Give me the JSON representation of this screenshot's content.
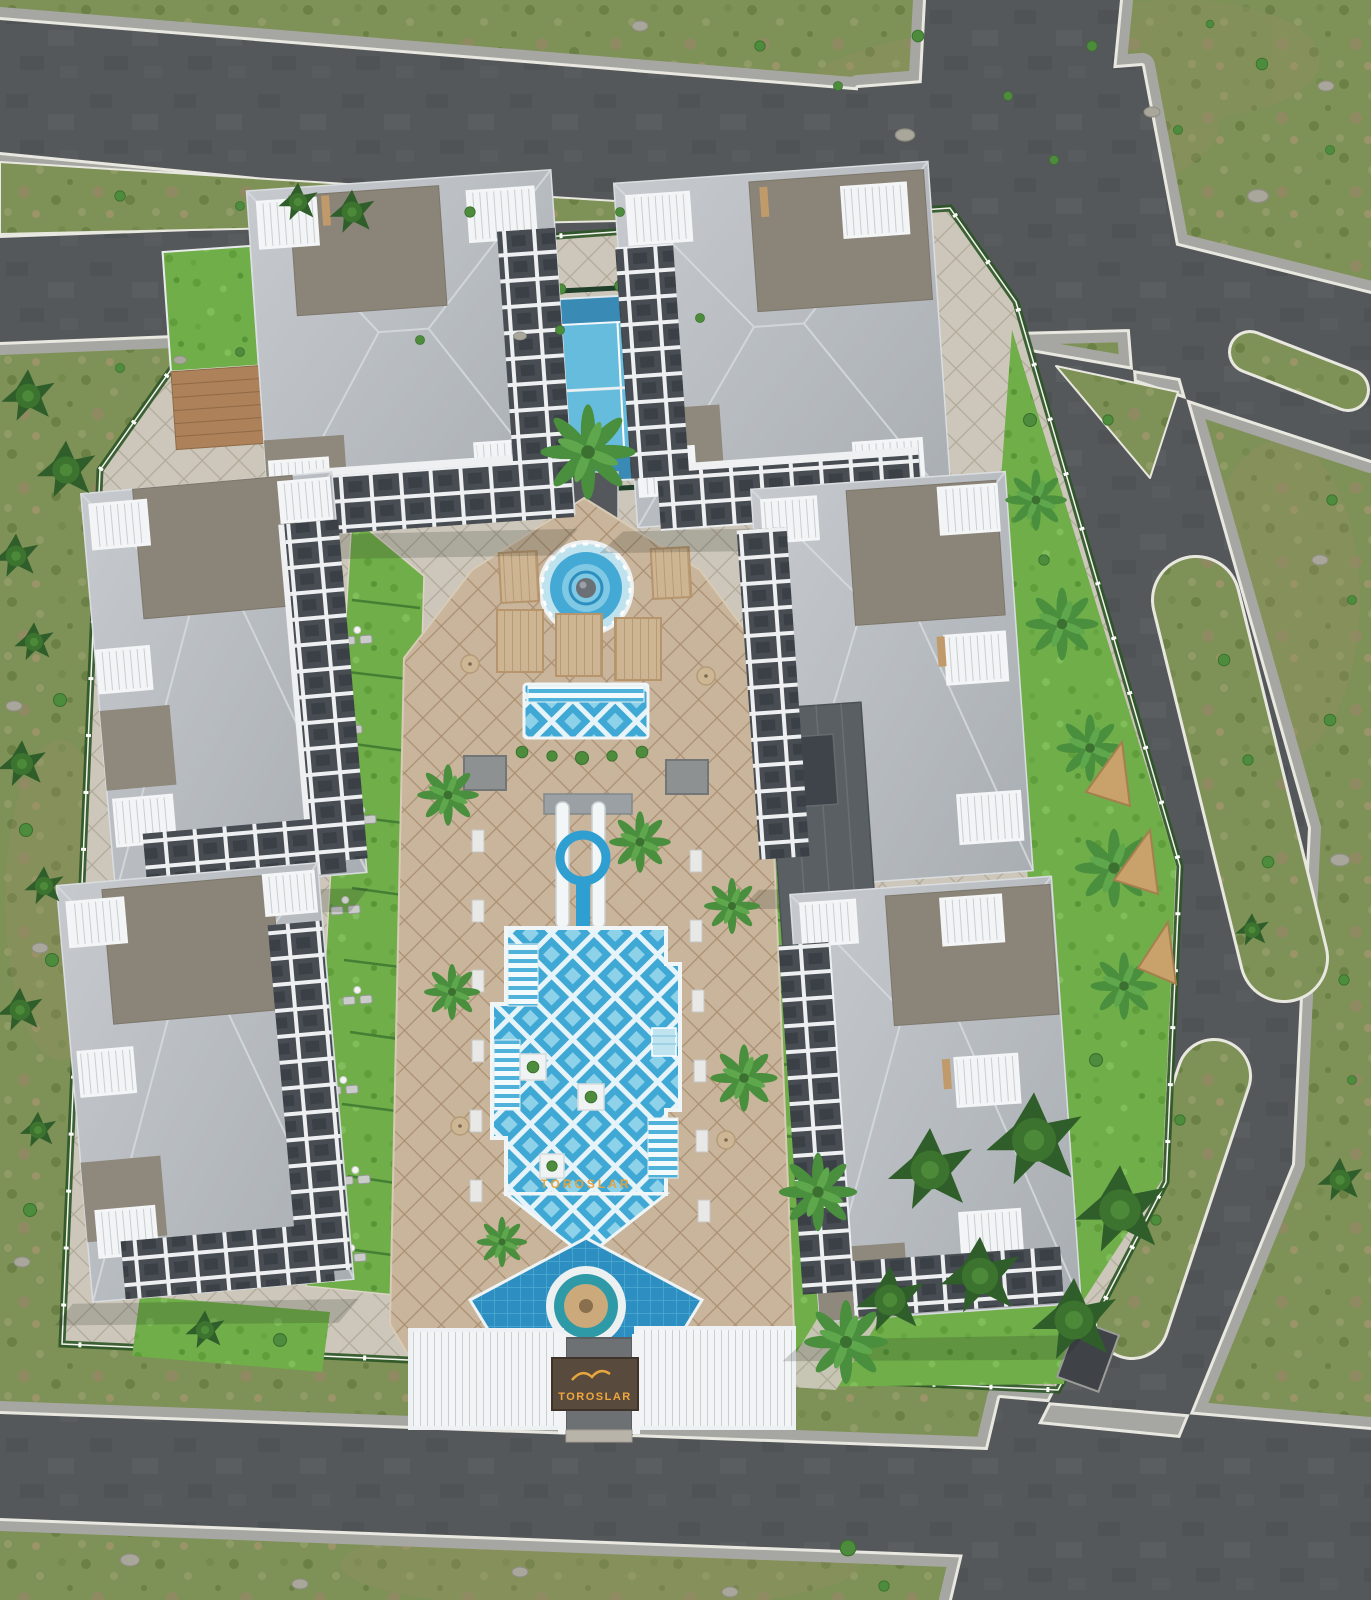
{
  "scene": {
    "type": "aerial architectural render",
    "description": "Bird's-eye 3D visualization of the Toroslar residential complex: six grey-and-white apartment blocks around a landscaped courtyard with pools, water slides, a tennis court and a gated entrance pergola, surrounded by roads and greenery.",
    "branding": {
      "entrance_sign_text": "TOROSLAR",
      "pool_floor_text": "TOROSLAR",
      "sign_text_color": "#f2a73e",
      "pool_text_color": "#e7a13a",
      "sign_panel_color": "#584a3c"
    },
    "counts": {
      "apartment_blocks": 6,
      "pools": 4,
      "water_slides": 3,
      "tennis_courts": 1,
      "entrance_gates": 1
    },
    "amenities": [
      "tennis court",
      "sphere fountain pool",
      "cabanas",
      "relaxation pool",
      "water slide tower",
      "main lattice-tiled pool",
      "in-pool loungers",
      "kids pool with island fountain",
      "entrance pergola",
      "rooftop garden",
      "rooftop pergolas",
      "palm garden",
      "pine garden",
      "sun-lounger lawns"
    ],
    "palette": {
      "road_asphalt": "#55585a",
      "sidewalk": "#a6a7a2",
      "curb_line": "#e9e8e0",
      "grass_outer": "#7e9157",
      "grass_inner": "#6fae49",
      "pavement_light": "#ccc7ba",
      "pool_deck_tan": "#c8b59c",
      "pool_water_light": "#7fc9e4",
      "pool_tile_blue": "#3fa8d4",
      "kids_pool_blue": "#2d8ec1",
      "roof_light_grey": "#b9bdc1",
      "roof_dark_patch": "#8b8478",
      "facade_dark_grey": "#474d53",
      "trim_white": "#eef0f2",
      "tennis_blue": "#3a8ab6",
      "tennis_inner_blue": "#66bcdc",
      "palm_green": "#4a8f3d",
      "conifer_green": "#2f5e2a"
    }
  }
}
